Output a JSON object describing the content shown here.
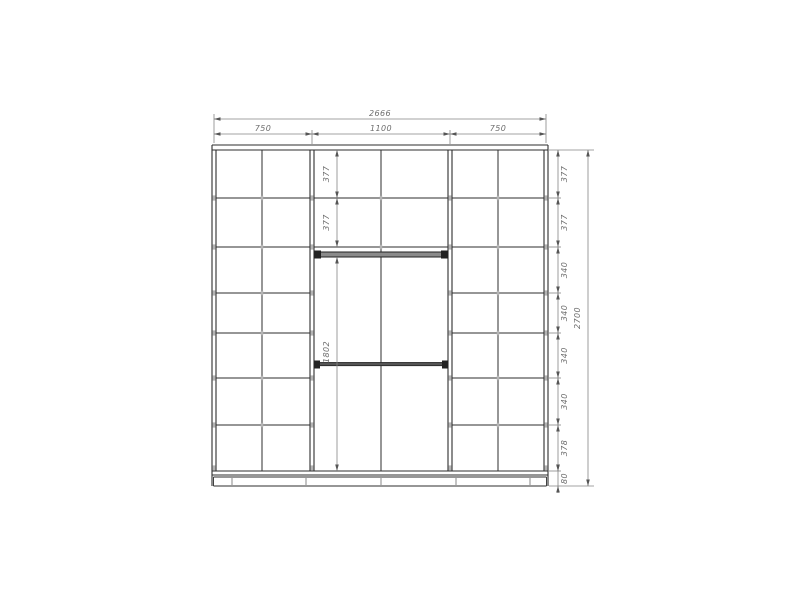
{
  "page": {
    "background": "#ffffff"
  },
  "drawing": {
    "type": "wardrobe-front-elevation",
    "dimensions": {
      "overall_width": "2666",
      "section_widths": [
        "750",
        "1100",
        "750"
      ],
      "overall_height": "2700",
      "right_row_heights": [
        "377",
        "377",
        "340",
        "340",
        "340",
        "340",
        "378",
        "80"
      ],
      "middle_top_rows": [
        "377",
        "377"
      ],
      "middle_open_height": "1802"
    },
    "colors": {
      "background": "#ffffff",
      "structure_line": "#2e2e2e",
      "dimension_line": "#848484",
      "dimension_text": "#6e6e6e",
      "joint_mark": "#b4b4b4",
      "shelf_fill": "#8a8a8a",
      "thick_edge": "#222222"
    }
  }
}
